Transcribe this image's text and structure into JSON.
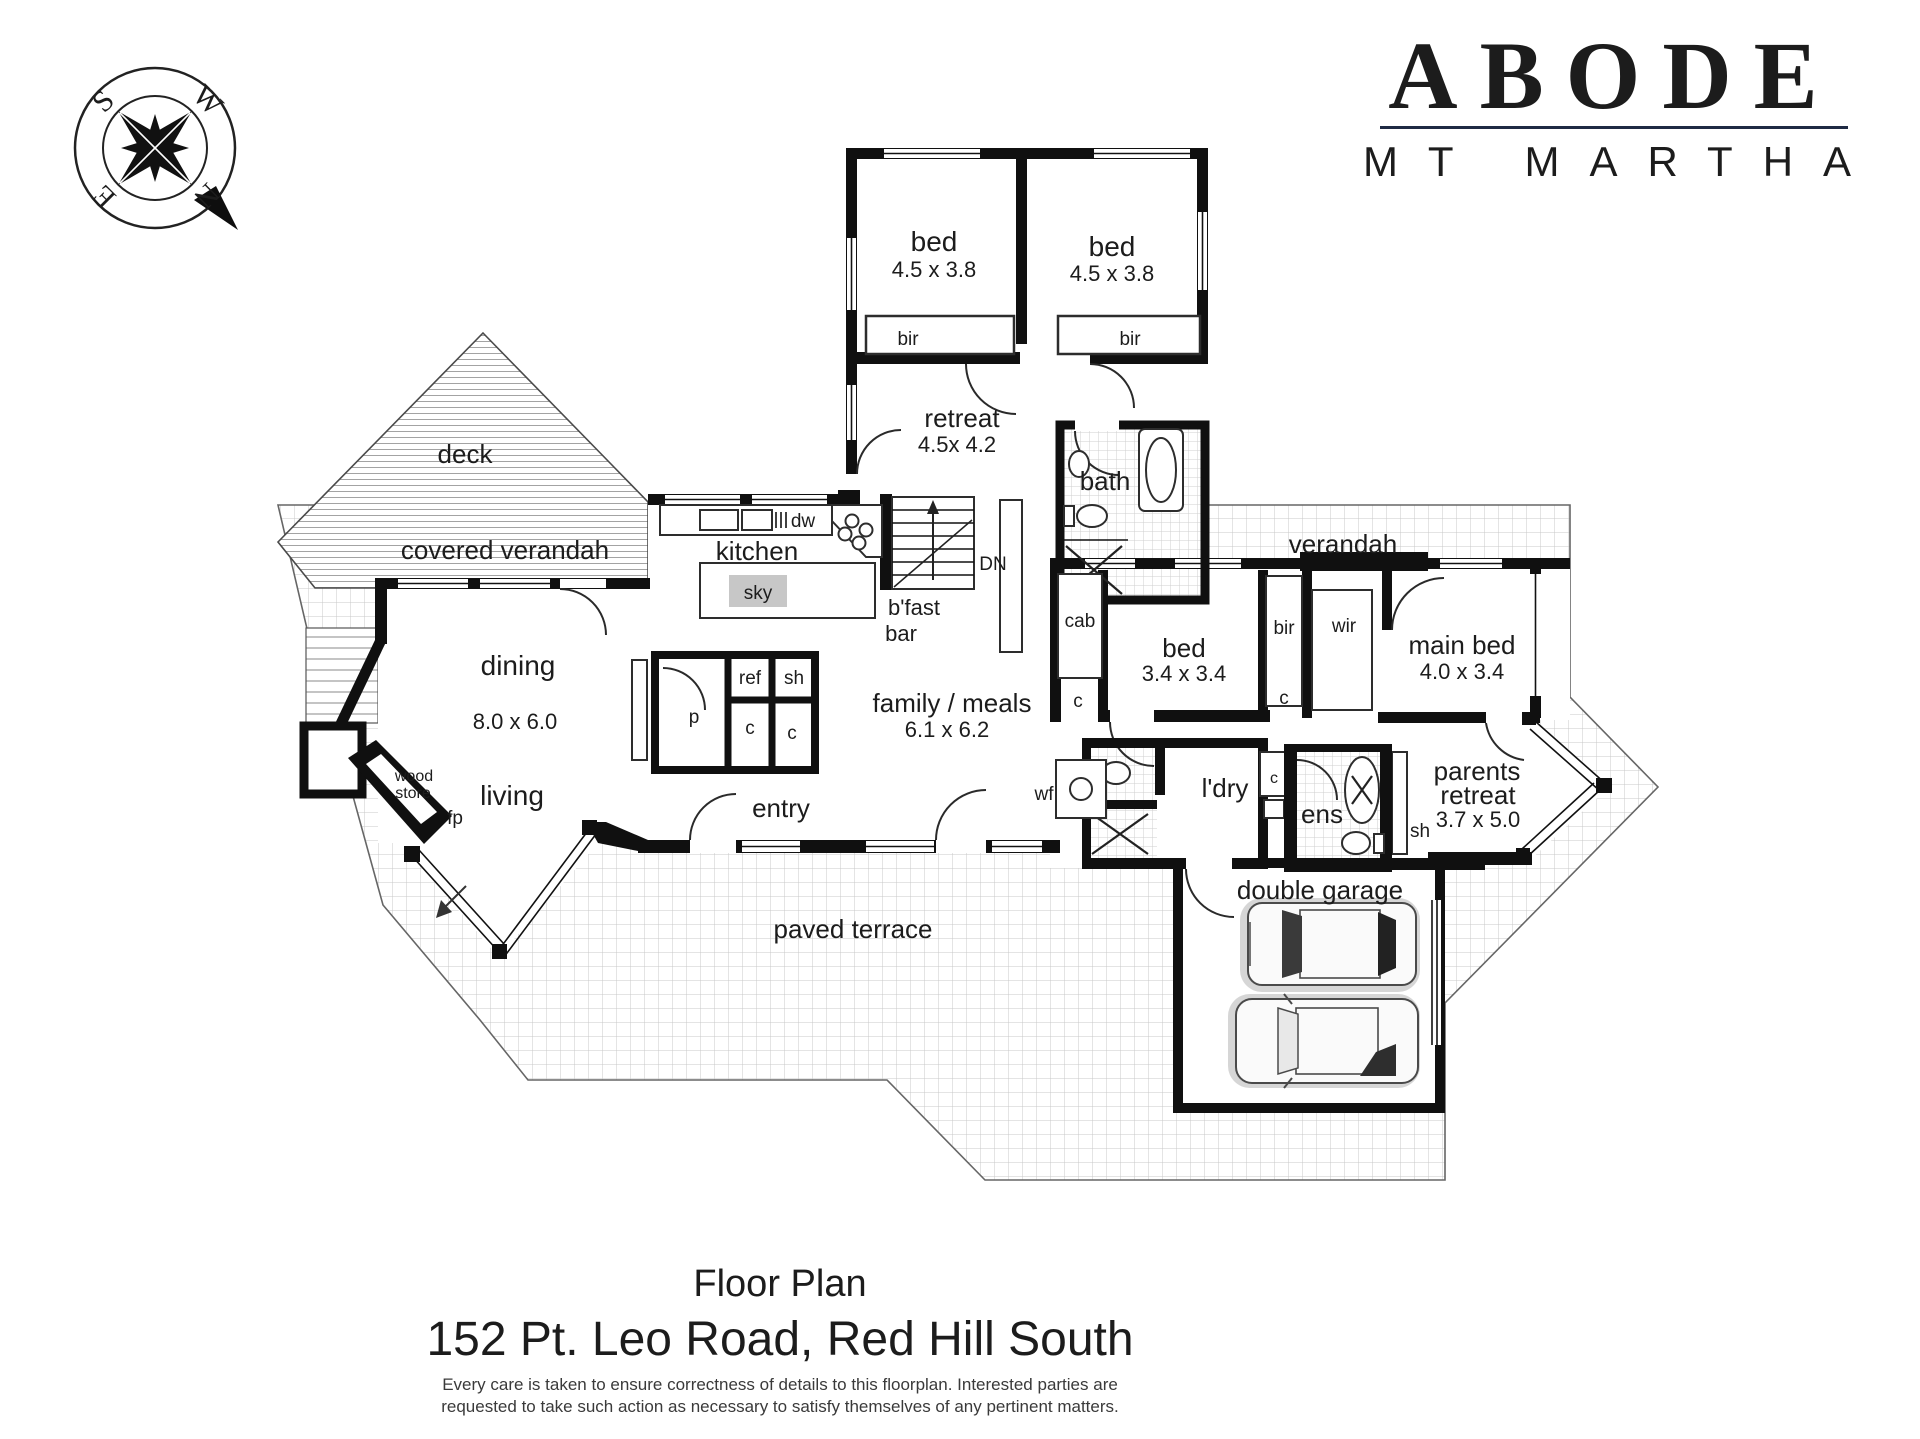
{
  "branding": {
    "name": "ABODE",
    "location": "MT MARTHA",
    "name_color": "#1f2a44",
    "location_color": "#8f8f8f"
  },
  "compass": {
    "n": "N",
    "s": "S",
    "e": "E",
    "w": "W"
  },
  "plan": {
    "labels": {
      "deck": "deck",
      "covered_verandah": "covered verandah",
      "verandah": "verandah",
      "paved_terrace": "paved terrace",
      "dining": "dining",
      "dining_dims": "8.0 x 6.0",
      "living": "living",
      "wood_store_1": "wood",
      "wood_store_2": "store",
      "fp": "fp",
      "kitchen": "kitchen",
      "sky": "sky",
      "dw": "dw",
      "dn": "DN",
      "bfast_1": "b'fast",
      "bfast_2": "bar",
      "ref": "ref",
      "sh": "sh",
      "pantry": "p",
      "cupboard": "c",
      "cab": "cab",
      "family": "family / meals",
      "family_dims": "6.1 x 6.2",
      "entry": "entry",
      "bed": "bed",
      "bed_45_dims": "4.5 x 3.8",
      "bir": "bir",
      "retreat": "retreat",
      "retreat_dims": "4.5x 4.2",
      "bath": "bath",
      "bed_34_dims": "3.4 x 3.4",
      "wir": "wir",
      "main_bed": "main bed",
      "main_bed_dims": "4.0 x 3.4",
      "ldry": "l'dry",
      "ens": "ens",
      "wf": "wf",
      "parents_1": "parents",
      "parents_2": "retreat",
      "parents_dims": "3.7 x 5.0",
      "double_garage": "double garage"
    }
  },
  "footer": {
    "title": "Floor Plan",
    "address": "152 Pt. Leo Road, Red Hill South",
    "disclaimer_1": "Every care is taken to ensure correctness of details to this floorplan. Interested parties are",
    "disclaimer_2": "requested to take such action as necessary to satisfy themselves of any pertinent matters."
  }
}
